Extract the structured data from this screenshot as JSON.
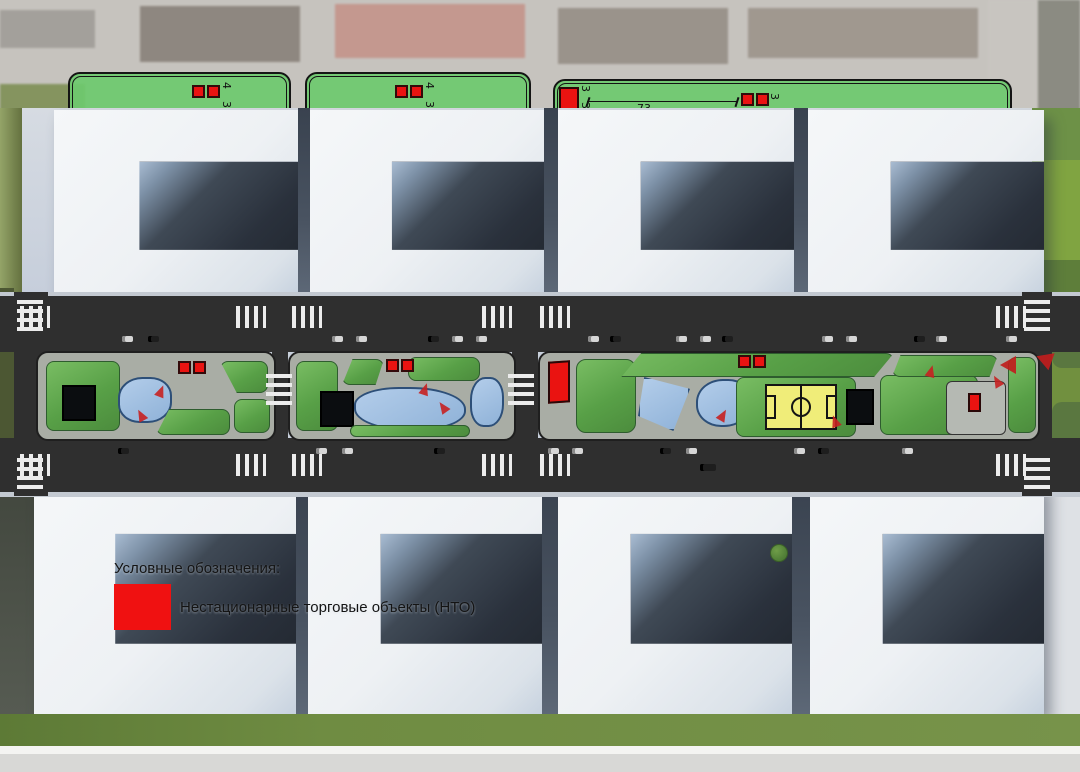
{
  "title": "Схема благоустройства бульвара с размещением НТО",
  "colors": {
    "nto_red": "#ee1311",
    "zone_green": "#72ca72",
    "park_green": "#5ea04c",
    "pond_blue": "#9fbede",
    "field_yellow": "#f0ed79",
    "road_dark": "#2f2f2f",
    "grass_olive": "#6f8c42",
    "building_white": "#eef1f4",
    "courtyard_dark": "#2e3540"
  },
  "aerial": {
    "zone_a": {
      "dim_h": "4",
      "dim_s": "3"
    },
    "zone_b": {
      "dim_h": "4",
      "dim_s": "3"
    },
    "zone_c": {
      "dim_len": "73",
      "dim_w": "4",
      "dim_s": "3",
      "dim_l1": "3",
      "dim_l2": "3"
    }
  },
  "legend": {
    "title": "Условные обозначения:",
    "nto_label": "Нестационарные торговые объекты (НТО)"
  }
}
